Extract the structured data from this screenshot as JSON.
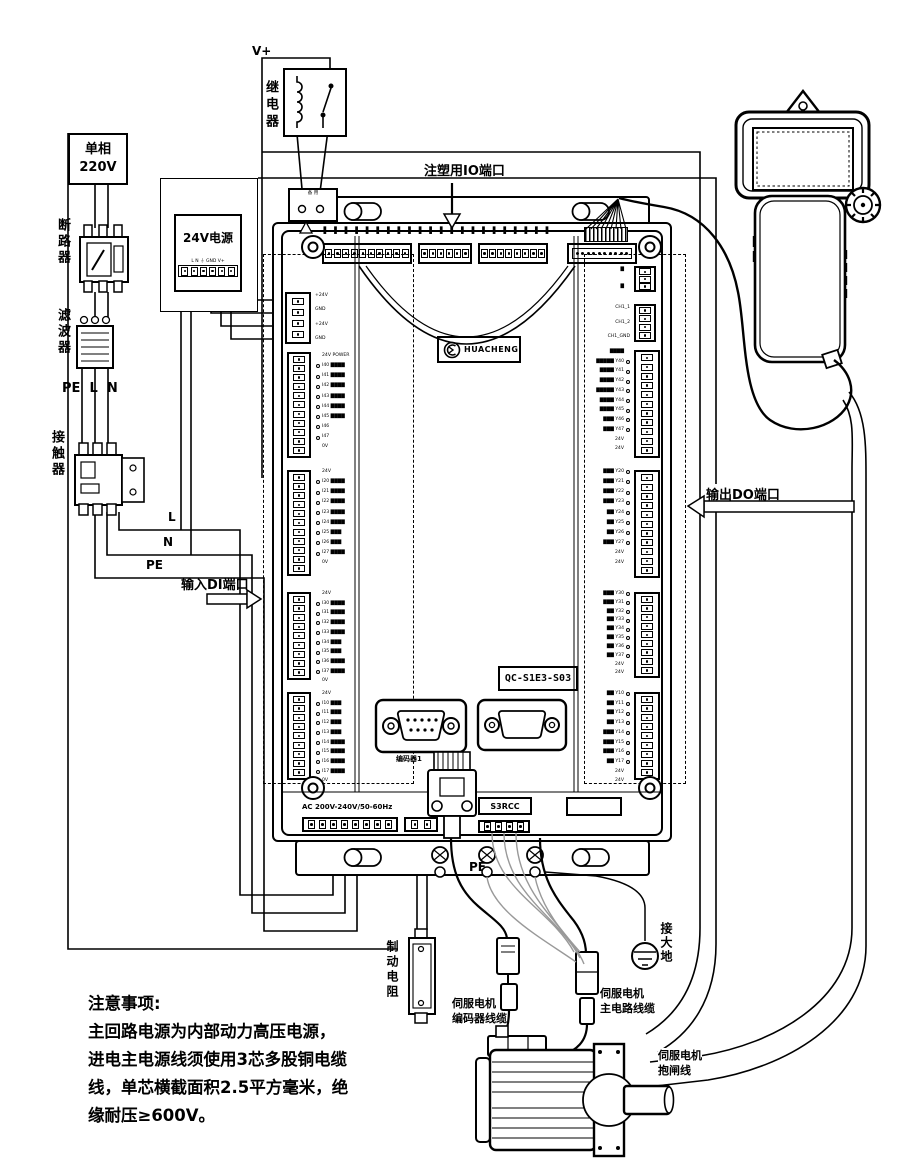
{
  "labels": {
    "v_plus": "V+",
    "relay": "继电器",
    "source_line1": "单相",
    "source_line2": "220V",
    "breaker": "断路器",
    "filter": "滤波器",
    "contactor": "接触器",
    "pe": "PE",
    "l": "L",
    "n": "N",
    "wire_l": "L",
    "wire_n": "N",
    "wire_pe": "PE",
    "power24": "24V电源",
    "power24_terminals": "L N ⏚ GND V+",
    "spare_terminal": "备 用",
    "ground": "接大地",
    "brake_resistor": "制动电阻",
    "pe_bottom": "PE"
  },
  "ports": {
    "io_top": "注塑用IO端口",
    "di": "输入DI端口",
    "do": "输出DO端口"
  },
  "controller": {
    "logo_text": "HUACHENG",
    "model": "QC-S1E3-S03",
    "encoder_label": "编码器1",
    "s3rcc": "S3RCC",
    "ac_rating": "AC 200V-240V/50-60Hz",
    "left_pin_labels": [
      "+24V",
      "GND",
      "+24V",
      "GND"
    ],
    "ch_labels": [
      "CH1_1",
      "CH1_2",
      "CH1_GND"
    ],
    "do_top_marks": [
      "▇",
      "▇"
    ],
    "top_micro": [
      "▇▇",
      "▇▇",
      "▇▇",
      "▇▇",
      "▇▇",
      "▇▇",
      "▇▇",
      "▇▇",
      "▇▇",
      "▇▇",
      "▇▇",
      "▇▇",
      "▇▇",
      "▇▇",
      "▇▇",
      "▇▇",
      "▇▇",
      "▇▇",
      "▇▇",
      "▇▇",
      "▇▇",
      "▇▇"
    ],
    "di_groups": [
      [
        "24V POWER",
        "I40 ▇▇▇▇",
        "I41 ▇▇▇▇",
        "I42 ▇▇▇▇",
        "I43 ▇▇▇▇",
        "I44 ▇▇▇▇",
        "I45 ▇▇▇▇",
        "I46",
        "I47",
        "0V"
      ],
      [
        "24V",
        "I20 ▇▇▇▇",
        "I21 ▇▇▇▇",
        "I22 ▇▇▇▇",
        "I23 ▇▇▇▇",
        "I24 ▇▇▇▇",
        "I25 ▇▇▇",
        "I26 ▇▇▇",
        "I27 ▇▇▇▇",
        "0V"
      ],
      [
        "24V",
        "I30 ▇▇▇▇",
        "I31 ▇▇▇▇",
        "I32 ▇▇▇▇",
        "I33 ▇▇▇▇",
        "I34 ▇▇▇",
        "I35 ▇▇▇",
        "I36 ▇▇▇▇",
        "I37 ▇▇▇▇",
        "0V"
      ],
      [
        "24V",
        "I10 ▇▇▇",
        "I11 ▇▇▇",
        "I12 ▇▇▇",
        "I13 ▇▇▇",
        "I14 ▇▇▇▇",
        "I15 ▇▇▇▇",
        "I16 ▇▇▇▇",
        "I17 ▇▇▇▇",
        "0V"
      ]
    ],
    "do_groups": [
      [
        "▇▇▇▇",
        "▇▇▇▇▇ Y40",
        "▇▇▇▇ Y41",
        "▇▇▇▇ Y42",
        "▇▇▇▇▇ Y43",
        "▇▇▇▇ Y44",
        "▇▇▇▇ Y45",
        "▇▇▇ Y46",
        "▇▇▇ Y47",
        "24V",
        "24V"
      ],
      [
        "▇▇▇ Y20",
        "▇▇▇ Y21",
        "▇▇▇ Y22",
        "▇▇▇ Y23",
        "▇▇ Y24",
        "▇▇ Y25",
        "▇▇ Y26",
        "▇▇▇ Y27",
        "24V",
        "24V"
      ],
      [
        "▇▇▇ Y30",
        "▇▇▇ Y31",
        "▇▇ Y32",
        "▇▇ Y33",
        "▇▇ Y34",
        "▇▇ Y35",
        "▇▇ Y36",
        "▇▇ Y37",
        "24V",
        "24V"
      ],
      [
        "▇▇ Y10",
        "▇▇ Y11",
        "▇▇ Y12",
        "▇▇ Y13",
        "▇▇▇ Y14",
        "▇▇▇ Y15",
        "▇▇▇ Y16",
        "▇▇ Y17",
        "24V",
        "24V"
      ]
    ]
  },
  "cables": {
    "encoder_line1": "伺服电机",
    "encoder_line2": "编码器线缆",
    "main_line1": "伺服电机",
    "main_line2": "主电路线缆",
    "brake_line1": "伺服电机",
    "brake_line2": "抱闸线"
  },
  "note": {
    "title": "注意事项:",
    "line1": "主回路电源为内部动力高压电源，",
    "line2": "进电主电源线须使用3芯多股铜电缆",
    "line3": "线，单芯横截面积2.5平方毫米，绝",
    "line4": "缘耐压≥600V。"
  }
}
